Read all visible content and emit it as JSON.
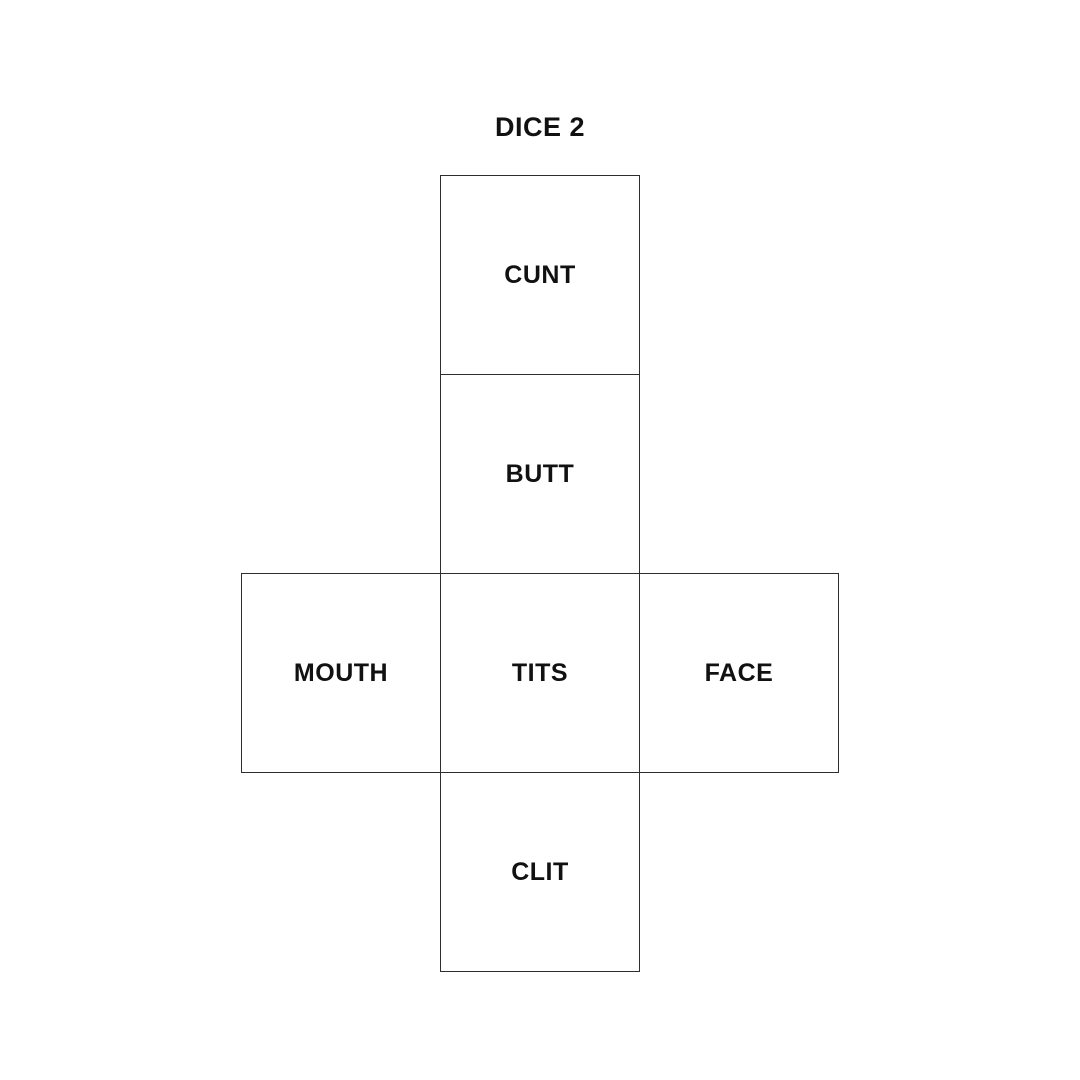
{
  "page": {
    "background_color": "#ffffff",
    "text_color": "#111111",
    "border_color": "#2e2e2e"
  },
  "title": "DICE 2",
  "dice_net": {
    "description": "cube net cross layout, six square faces",
    "cells": [
      {
        "position": "top",
        "label": "CUNT"
      },
      {
        "position": "upper-middle",
        "label": "BUTT"
      },
      {
        "position": "middle-left",
        "label": "MOUTH"
      },
      {
        "position": "middle-center",
        "label": "TITS"
      },
      {
        "position": "middle-right",
        "label": "FACE"
      },
      {
        "position": "bottom",
        "label": "CLIT"
      }
    ]
  }
}
